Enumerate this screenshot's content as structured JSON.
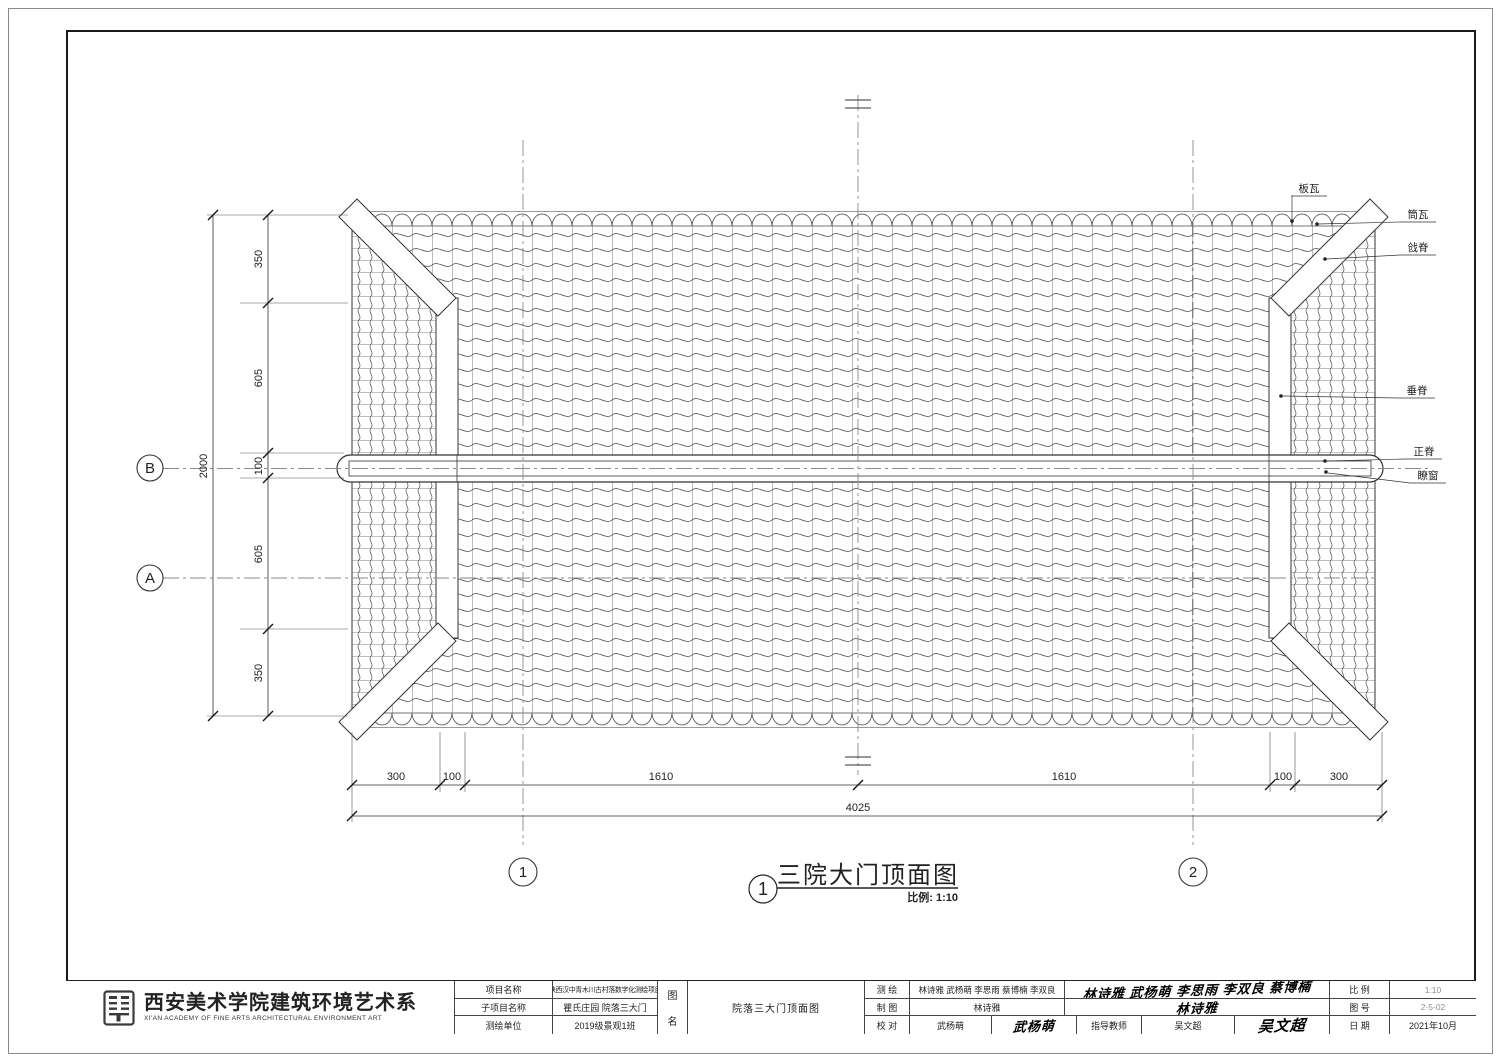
{
  "colors": {
    "line": "#333333",
    "tile_line": "#4a4a4a",
    "axis_line": "#8a8a8a",
    "paper": "#ffffff",
    "text": "#222222",
    "faint_value": "#8f8f8f"
  },
  "drawing": {
    "view_number": "1",
    "title": "三院大门顶面图",
    "scale_note": "比例: 1:10",
    "grid": {
      "row_b": "B",
      "row_a": "A",
      "col_1": "1",
      "col_2": "2"
    },
    "annotations": {
      "ban_wa": "板瓦",
      "tong_wa": "筒瓦",
      "qiang_ji": "戗脊",
      "chui_ji": "垂脊",
      "zheng_ji": "正脊",
      "liao_chuang": "瞭窗"
    },
    "dims": {
      "left_total": "2000",
      "left_segs": [
        "350",
        "605",
        "100",
        "605",
        "350"
      ],
      "bottom_segs": [
        "300",
        "100",
        "1610",
        "1610",
        "100",
        "300"
      ],
      "bottom_total": "4025"
    }
  },
  "titleblock": {
    "school_cn": "西安美术学院建筑环境艺术系",
    "school_en": "XI'AN ACADEMY OF FINE ARTS ARCHITECTURAL ENVIRONMENT ART",
    "project_label": "项目名称",
    "project_value": "陕西汉中青木川古村落数字化测绘项目",
    "subproject_label": "子项目名称",
    "subproject_value": "瞿氏庄园 院落三大门",
    "unit_label": "测绘单位",
    "unit_value": "2019级景观1班",
    "sheet_label_top": "图",
    "sheet_label_bottom": "名",
    "sheet_value": "院落三大门顶面图",
    "survey_label": "测    绘",
    "survey_value": "林诗雅 武杨萌 李思雨 蔡博楠 李双良",
    "draft_label": "制    图",
    "draft_value": "林诗雅",
    "check_label": "校    对",
    "check_value": "武杨萌",
    "advisor_label": "指导教师",
    "advisor_value": "吴文超",
    "sig_survey": "林诗雅 武杨萌 李思雨 李双良 蔡博楠",
    "sig_draft": "林诗雅",
    "sig_check": "武杨萌",
    "sig_advisor": "吴文超",
    "scale_label": "比    例",
    "scale_value": "1:10",
    "number_label": "图    号",
    "number_value": "2-5-02",
    "date_label": "日    期",
    "date_value": "2021年10月"
  }
}
